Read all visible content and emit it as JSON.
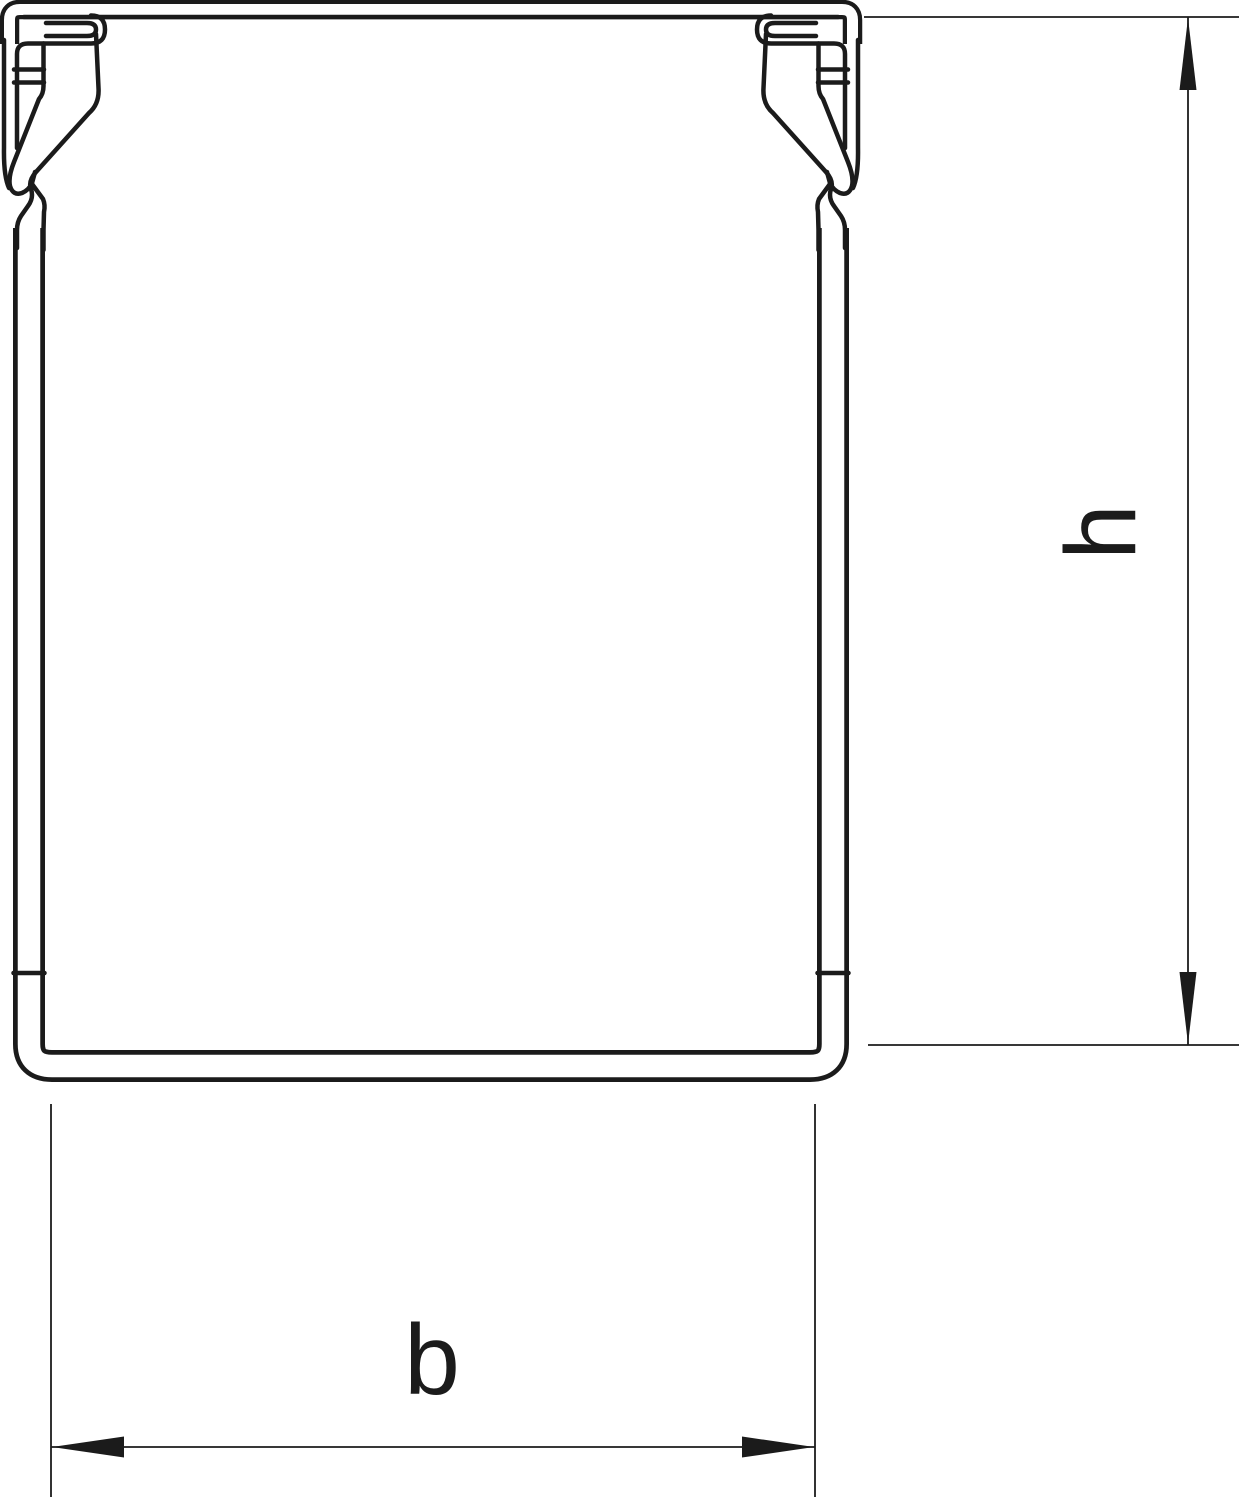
{
  "drawing": {
    "height_dimension_label": "h",
    "width_dimension_label": "b"
  },
  "colors": {
    "line": "#1b1b1b",
    "background": "#ffffff"
  }
}
